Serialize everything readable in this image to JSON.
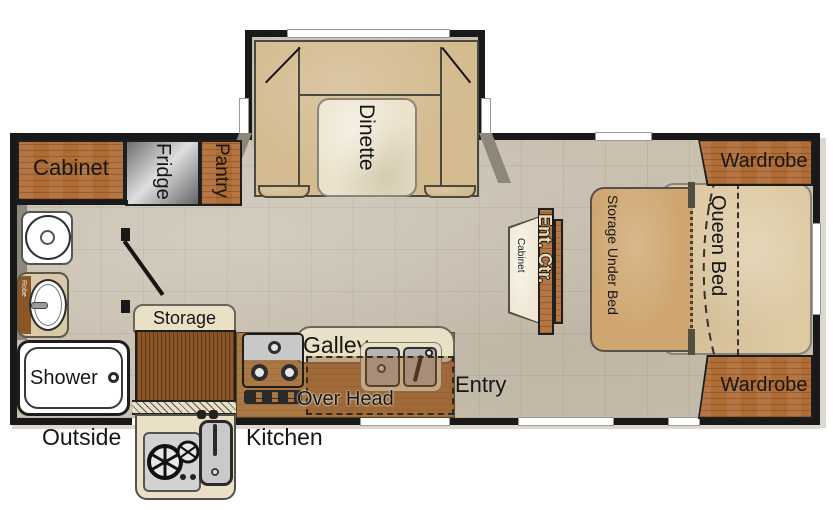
{
  "kitchen_area": {
    "cabinet": "Cabinet",
    "fridge": "Fridge",
    "pantry": "Pantry",
    "storage": "Storage",
    "galley": "Galley",
    "over_head": "Over Head",
    "outside": "Outside",
    "kitchen": "Kitchen"
  },
  "dinette": {
    "label": "Dinette"
  },
  "bathroom": {
    "shower": "Shower",
    "robe": "Robe"
  },
  "living": {
    "ent_ctr": "Ent. Ctr.",
    "ent_cabinet": "Cabinet",
    "entry": "Entry"
  },
  "bedroom": {
    "wardrobe_top": "Wardrobe",
    "wardrobe_bottom": "Wardrobe",
    "queen_bed": "Queen Bed",
    "storage_under_bed": "Storage Under Bed"
  },
  "colors": {
    "wood": "#b06c35",
    "wood-dark": "#8a5527",
    "floor": "#c9c0b0",
    "bench": "#d4bb90",
    "table": "#ebe2cb",
    "bed": "#ddc9a2",
    "bedstore": "#cfa670",
    "wall": "#191919",
    "counter": "#aa7845",
    "cream": "#e9e0c6"
  }
}
